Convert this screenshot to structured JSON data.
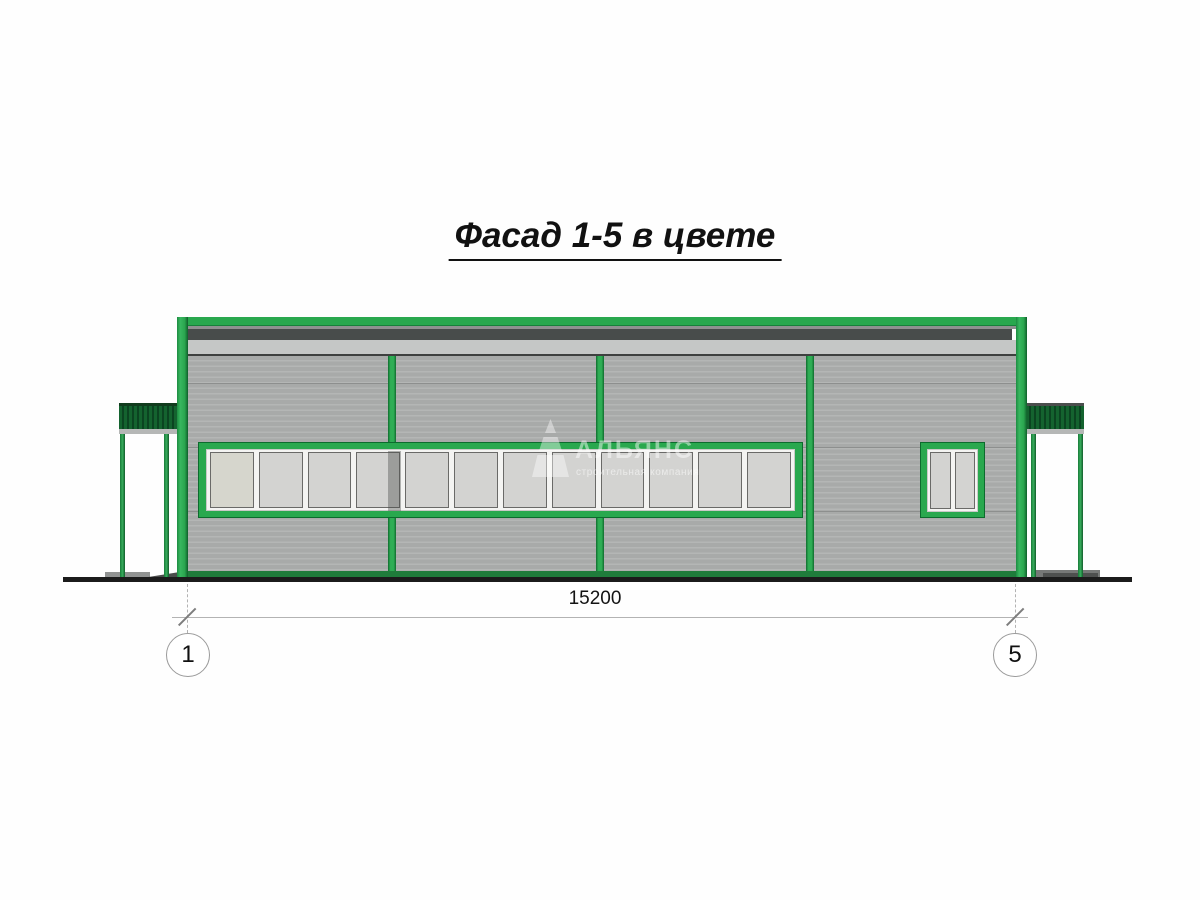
{
  "title": {
    "text": "Фасад 1-5 в цвете"
  },
  "dimension": {
    "value": "15200"
  },
  "axis_markers": {
    "left": "1",
    "right": "5"
  },
  "watermark": {
    "name": "АЛЬЯНС",
    "tagline": "строительная компания"
  },
  "window_band": {
    "pane_count": 12
  },
  "small_window": {
    "pane_count": 2
  },
  "colors": {
    "frame_green": "#29a84e",
    "frame_green_dark": "#0c6b2d",
    "canopy_green": "#14632f",
    "canopy_green_dark": "#0b4421",
    "plinth_green": "#1f7c3b",
    "siding_gray": "#a8aaa9",
    "siding_line": "#b4b6b5",
    "band_dark_gray": "#484c4b",
    "band_light_gray": "#c5c7c6",
    "pane_gray": "#d3d3d1",
    "pane_first": "#d6d6cd",
    "white_frame": "#f4f4f2",
    "ground_black": "#1b1b1b",
    "text_black": "#141414"
  }
}
